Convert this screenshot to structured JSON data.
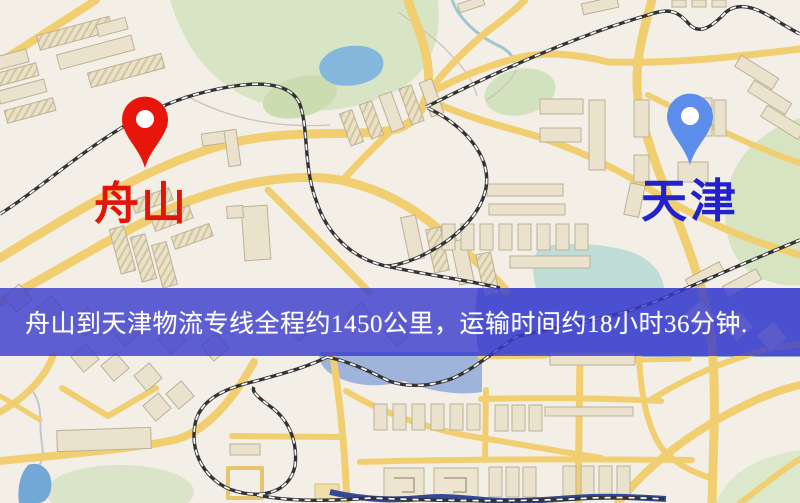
{
  "banner": {
    "text": "舟山到天津物流专线全程约1450公里，运输时间约18小时36分钟.",
    "bg_color": "rgba(56,58,206,0.8)",
    "text_color": "#FFFFFF"
  },
  "markers": {
    "origin": {
      "label": "舟山",
      "pin_color": "#E8150A",
      "label_color": "#E51408"
    },
    "destination": {
      "label": "天津",
      "pin_color": "#5C8DEA",
      "label_color": "#2222CC"
    }
  },
  "route": {
    "distance": "约1450公里",
    "duration": "约18小时36分钟"
  },
  "map_colors": {
    "background": "#F3EFE7",
    "road": "#F3CE6B",
    "park": "#D8E5C3",
    "water": "#84B7DE",
    "building": "#EAE2CB",
    "railway": "#333333"
  }
}
